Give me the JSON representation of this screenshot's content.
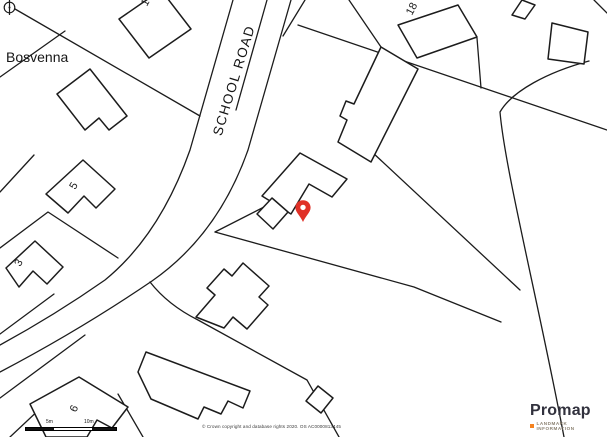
{
  "map": {
    "road_label": "SCHOOL ROAD",
    "property_name": "Bosvenna",
    "house_numbers": [
      {
        "label": "17"
      },
      {
        "label": "18"
      },
      {
        "label": "5"
      },
      {
        "label": "3"
      },
      {
        "label": "9"
      }
    ],
    "marker_color": "#e03127",
    "line_color": "#1c1c1c",
    "background_color": "#ffffff"
  },
  "scale_bar": {
    "labels": [
      "5m",
      "10m"
    ]
  },
  "attribution": "© Crown copyright and database rights 2020. OS AC0000813445",
  "branding": {
    "logo_text": "Promap",
    "tagline": "LANDMARK INFORMATION",
    "logo_color": "#31313d",
    "accent_color": "#f5821f"
  }
}
